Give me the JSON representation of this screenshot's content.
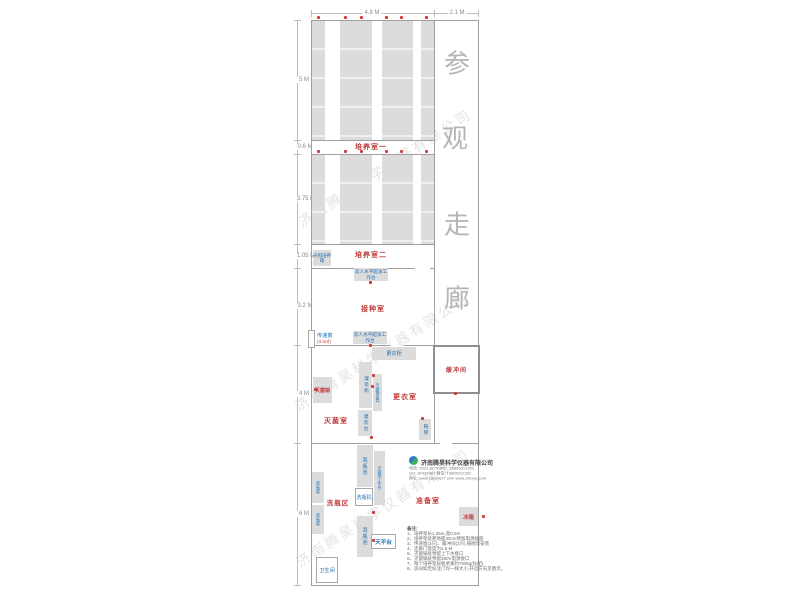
{
  "watermark_text": "济南腾昊科学仪器有限公司",
  "dimensions": {
    "top": [
      "4.8 M",
      "2.1 M"
    ],
    "left": [
      "5 M",
      "0.6 M",
      "3.75 M",
      "1.05 M",
      "3.2 M",
      "4 M",
      "6 M"
    ]
  },
  "corridor_chars": [
    "参",
    "观",
    "走",
    "廊"
  ],
  "rooms": {
    "culture1": "培养室一",
    "culture2": "培养室二",
    "inoculation": "接种室",
    "sterilization": "灭菌室",
    "changing": "更衣室",
    "buffer": "缓冲间",
    "washing": "洗瓶区",
    "prep": "准备室",
    "toilet": "卫生间"
  },
  "equipment": {
    "light_incubator": "光照培养箱",
    "clean_bench_1": "双人水平超净工作台",
    "clean_bench_2": "双人水平超净工作台",
    "pass_window": "传递窗",
    "pass_window_area": "(3.6㎡)",
    "locker": "更衣柜",
    "filling_machine": "灌装机",
    "ss_stool": "不锈钢条凳",
    "filling_table": "灌装台",
    "sterilizer_pot": "灭菌锅",
    "shoe_rack": "鞋架",
    "soak_pool_1": "泡瓶池",
    "soak_pool_2": "泡瓶池",
    "ss_worktable": "不锈钢工作台",
    "bottle_washer": "洗瓶机",
    "bottle_rack_1": "放瓶架",
    "bottle_rack_2": "放瓶架",
    "balance_table": "天平台",
    "fridge": "冰箱"
  },
  "company": {
    "name": "济南腾昊科学仪器有限公司",
    "line1": "电话: 0531-87799827, 15866012352",
    "line2": "QQ: 87437487    微信: 15866012352",
    "line3": "网址: www.sdkxyq17.com   www.cnkxyq.com"
  },
  "notes": {
    "heading": "备注:",
    "items": [
      "1、培养架长1.25m,宽0.5m",
      "2、培养架处距地面30cm预留电源插座",
      "3、传递窗(3只)、缓冲间(2只),按图示安装",
      "4、走廊门宽度为1.5 M",
      "5、灭菌锅处预留上下水接口",
      "6、灭菌锅处预留380V电源接口",
      "7、每个培养架层板承重约750kg(标配)",
      "8、房间如无标注门均一样大小,开启方向见图示。"
    ]
  },
  "colors": {
    "room_label": "#c23b3b",
    "equipment_label": "#2471b8",
    "rack_fill": "#dcdcdc",
    "wall": "#9f9f9f",
    "watermark": "#cfcfcf",
    "corridor_text": "#b5b5b5",
    "outlet_dot": "#d03a3a"
  }
}
